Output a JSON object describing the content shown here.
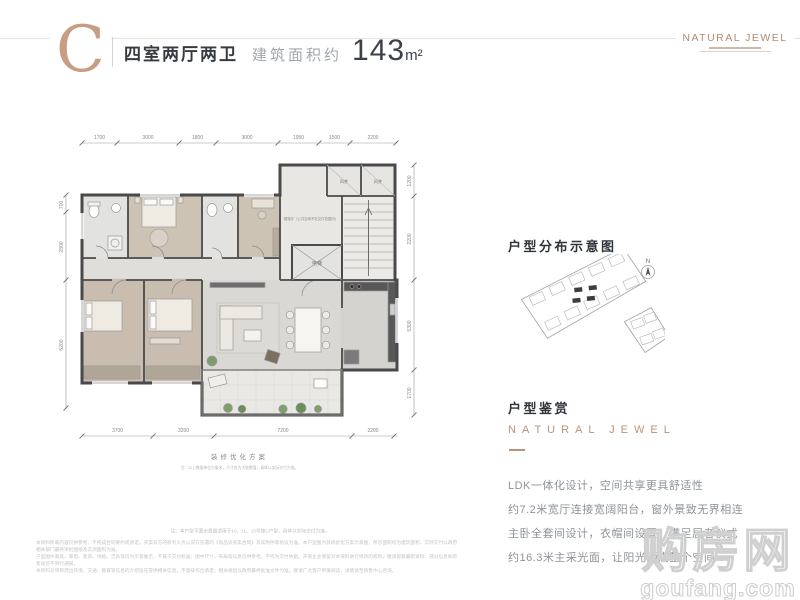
{
  "header": {
    "type_letter": "C",
    "title": "四室两厅两卫",
    "area_label": "建筑面积约",
    "area_value": "143",
    "area_unit": "m²",
    "brand": "NATURAL JEWEL"
  },
  "floor_plan": {
    "dims_top": [
      "1700",
      "3000",
      "1800",
      "3000",
      "1950",
      "1500",
      "2200"
    ],
    "dims_bottom": [
      "3700",
      "3200",
      "7200",
      "2200"
    ],
    "dims_left": [
      "700",
      "2800",
      "5200"
    ],
    "dims_right": [
      "1200",
      "2200",
      "5300",
      "1700"
    ],
    "labels": {
      "lobby": "候梯厅（公共空间不在交付范围内）",
      "elevator": "电梯",
      "shaft1": "风井",
      "shaft2": "风井"
    },
    "caption": "装修优化方案",
    "caption_note": "注：以上数据单位为毫米，尺寸仅为大致数值，具体以实际交付为准。"
  },
  "sidebar": {
    "distribution_title": "户型分布示意图",
    "compass_label": "N",
    "appreciation_title": "户型鉴赏",
    "brand_text": "NATURAL JEWEL",
    "description_lines": [
      "LDK一体化设计，空间共享更具舒适性",
      "约7.2米宽厅连接宽阔阳台，窗外景致无界相连",
      "主卧全套间设计，衣帽间设置，满足居者仪式",
      "约16.3米主采光面，让阳光洒满整个空间"
    ]
  },
  "watermark": {
    "name": "购房网",
    "domain": "goufang.com"
  },
  "footer": {
    "note_line": "注：本户型平面示意图适用于10、11、15号楼C户型，具体以实际交付为准。",
    "disclaimer_lines": [
      "本资料所载内容仅供参考，不构成合同要约或承诺，买卖双方的权利义务以双方签署的《商品房买卖合同》及其附件等协议为准。本户型图为装修优化方案示意图，所示面积均为建筑面积，实际交付以政府相关部门最终审批图纸及实测面积为准。",
      "户型图中家具、家电、装饰、绿植、洁具等仅为示意展示，不属于交付标准；图中尺寸、布局等信息仅供参考，不作为交付依据。开发企业保留对本资料进行修改的权利，敬请留意最新资料，部分信息如有变动恕不另行通知。",
      "本资料对项目周边环境、交通、教育等信息的介绍旨在提供相关信息，不意味作出承诺；相关规划以政府最终批准文件为准。敬请广大客户审慎阅读，详情请至销售中心咨询。"
    ]
  }
}
